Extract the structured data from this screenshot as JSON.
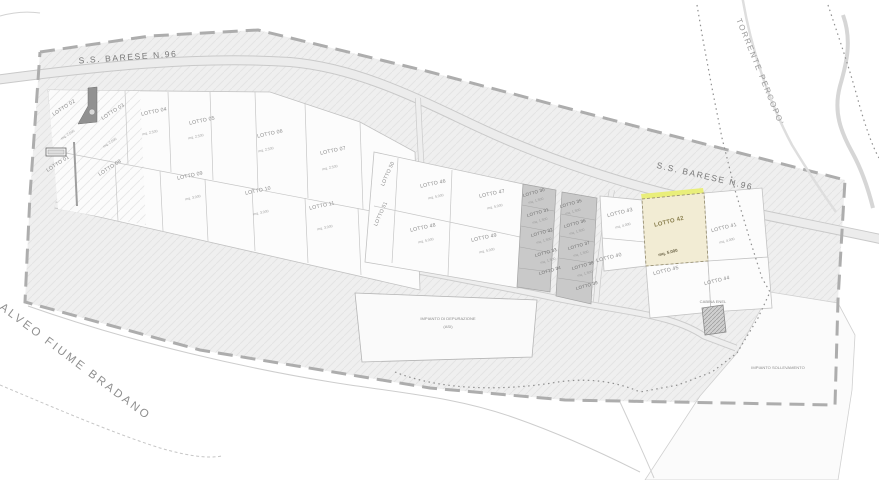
{
  "map": {
    "labels": [
      {
        "text": "S.S. BARESE N.96",
        "x": 128,
        "y": 57,
        "rot": -4,
        "cls": "road",
        "name": "road-label-ss-barese-west"
      },
      {
        "text": "S.S. BARESE N.96",
        "x": 705,
        "y": 176,
        "rot": 13,
        "cls": "road",
        "name": "road-label-ss-barese-east"
      },
      {
        "text": "TORRENTE PERCOPO'",
        "x": 760,
        "y": 72,
        "rot": 68,
        "cls": "water",
        "name": "water-label-torrente-percopo"
      },
      {
        "text": "ALVEO FIUME BRADANO",
        "x": 75,
        "y": 362,
        "rot": 37,
        "cls": "water big",
        "name": "water-label-fiume-bradano"
      },
      {
        "text": "IMPIANTO DI DEPURAZIONE",
        "x": 448,
        "y": 319,
        "rot": 0,
        "cls": "area",
        "name": "area-label-depuratore-line1"
      },
      {
        "text": "(ASI)",
        "x": 448,
        "y": 327,
        "rot": 0,
        "cls": "area",
        "name": "area-label-depuratore-line2"
      },
      {
        "text": "IMPIANTO SOLLEVAMENTO",
        "x": 778,
        "y": 368,
        "rot": 0,
        "cls": "area",
        "name": "area-label-sollevamento"
      },
      {
        "text": "CABINA ENEL",
        "x": 713,
        "y": 302,
        "rot": 0,
        "cls": "area",
        "name": "area-label-cabina"
      }
    ],
    "lots": [
      {
        "label": "LOTTO 02",
        "x": 64,
        "y": 108,
        "rot": -33,
        "sub": "mq. 2.500",
        "sx": 68,
        "sy": 135
      },
      {
        "label": "LOTTO 03",
        "x": 113,
        "y": 112,
        "rot": -33,
        "sub": "mq. 2.500",
        "sx": 110,
        "sy": 143
      },
      {
        "label": "LOTTO 04",
        "x": 154,
        "y": 112,
        "rot": -12,
        "sub": "mq. 2.500",
        "sx": 150,
        "sy": 133
      },
      {
        "label": "LOTTO 05",
        "x": 202,
        "y": 121,
        "rot": -12,
        "sub": "mq. 2.500",
        "sx": 196,
        "sy": 137
      },
      {
        "label": "LOTTO 06",
        "x": 270,
        "y": 134,
        "rot": -12,
        "sub": "mq. 2.500",
        "sx": 266,
        "sy": 150
      },
      {
        "label": "LOTTO 07",
        "x": 333,
        "y": 151,
        "rot": -12,
        "sub": "mq. 2.500",
        "sx": 330,
        "sy": 168
      },
      {
        "label": "LOTTO 01",
        "x": 58,
        "y": 164,
        "rot": -33
      },
      {
        "label": "LOTTO 08",
        "x": 110,
        "y": 168,
        "rot": -33
      },
      {
        "label": "LOTTO 09",
        "x": 190,
        "y": 176,
        "rot": -12,
        "sub": "mq. 3.000",
        "sx": 193,
        "sy": 198
      },
      {
        "label": "LOTTO 10",
        "x": 258,
        "y": 191,
        "rot": -12,
        "sub": "mq. 3.000",
        "sx": 261,
        "sy": 213
      },
      {
        "label": "LOTTO 11",
        "x": 322,
        "y": 206,
        "rot": -12,
        "sub": "mq. 3.000",
        "sx": 325,
        "sy": 228
      },
      {
        "label": "LOTTO 50",
        "x": 388,
        "y": 174,
        "rot": -66
      },
      {
        "label": "LOTTO 51",
        "x": 381,
        "y": 214,
        "rot": -66
      },
      {
        "label": "LOTTO 46",
        "x": 433,
        "y": 184,
        "rot": -12,
        "sub": "mq. 5.000",
        "sx": 436,
        "sy": 197
      },
      {
        "label": "LOTTO 47",
        "x": 492,
        "y": 194,
        "rot": -12,
        "sub": "mq. 5.000",
        "sx": 495,
        "sy": 207
      },
      {
        "label": "LOTTO 48",
        "x": 423,
        "y": 228,
        "rot": -12,
        "sub": "mq. 5.000",
        "sx": 426,
        "sy": 241
      },
      {
        "label": "LOTTO 49",
        "x": 484,
        "y": 238,
        "rot": -12,
        "sub": "mq. 5.000",
        "sx": 487,
        "sy": 251
      },
      {
        "label": "LOTTO 30",
        "x": 534,
        "y": 193,
        "rot": -16,
        "cls": "gray",
        "sub": "mq. 1.500",
        "sx": 536,
        "sy": 201
      },
      {
        "label": "LOTTO 31",
        "x": 538,
        "y": 213,
        "rot": -16,
        "cls": "gray",
        "sub": "mq. 1.500",
        "sx": 540,
        "sy": 221
      },
      {
        "label": "LOTTO 32",
        "x": 542,
        "y": 233,
        "rot": -16,
        "cls": "gray",
        "sub": "mq. 1.500",
        "sx": 544,
        "sy": 241
      },
      {
        "label": "LOTTO 33",
        "x": 546,
        "y": 253,
        "rot": -16,
        "cls": "gray",
        "sub": "mq. 1.500",
        "sx": 548,
        "sy": 261
      },
      {
        "label": "LOTTO 34",
        "x": 550,
        "y": 271,
        "rot": -16,
        "cls": "gray"
      },
      {
        "label": "LOTTO 35",
        "x": 571,
        "y": 204,
        "rot": -16,
        "cls": "gray",
        "sub": "mq. 1.500",
        "sx": 573,
        "sy": 212
      },
      {
        "label": "LOTTO 36",
        "x": 575,
        "y": 224,
        "rot": -16,
        "cls": "gray",
        "sub": "mq. 1.500",
        "sx": 577,
        "sy": 232
      },
      {
        "label": "LOTTO 37",
        "x": 579,
        "y": 246,
        "rot": -16,
        "cls": "gray",
        "sub": "mq. 1.500",
        "sx": 581,
        "sy": 254
      },
      {
        "label": "LOTTO 38",
        "x": 583,
        "y": 266,
        "rot": -16,
        "cls": "gray",
        "sub": "mq. 1.500",
        "sx": 585,
        "sy": 274
      },
      {
        "label": "LOTTO 39",
        "x": 587,
        "y": 286,
        "rot": -16,
        "cls": "gray"
      },
      {
        "label": "LOTTO 43",
        "x": 620,
        "y": 213,
        "rot": -14,
        "sub": "mq. 4.000",
        "sx": 623,
        "sy": 226
      },
      {
        "label": "LOTTO 40",
        "x": 609,
        "y": 258,
        "rot": -14
      },
      {
        "label": "LOTTO 42",
        "x": 669,
        "y": 222,
        "rot": -14,
        "hl": true,
        "sub": "mq. 5.000",
        "sx": 668,
        "sy": 253
      },
      {
        "label": "LOTTO 41",
        "x": 724,
        "y": 228,
        "rot": -14,
        "sub": "mq. 4.000",
        "sx": 727,
        "sy": 241
      },
      {
        "label": "LOTTO 45",
        "x": 666,
        "y": 271,
        "rot": -14
      },
      {
        "label": "LOTTO 44",
        "x": 717,
        "y": 281,
        "rot": -14
      }
    ],
    "colors": {
      "highlight_fill": "#f2ecd4",
      "highlight_edge": "#e9ee7a",
      "zone_fill": "#efefef",
      "gray_lot": "#c9c9c9",
      "boundary_dash": "#adadad"
    }
  }
}
